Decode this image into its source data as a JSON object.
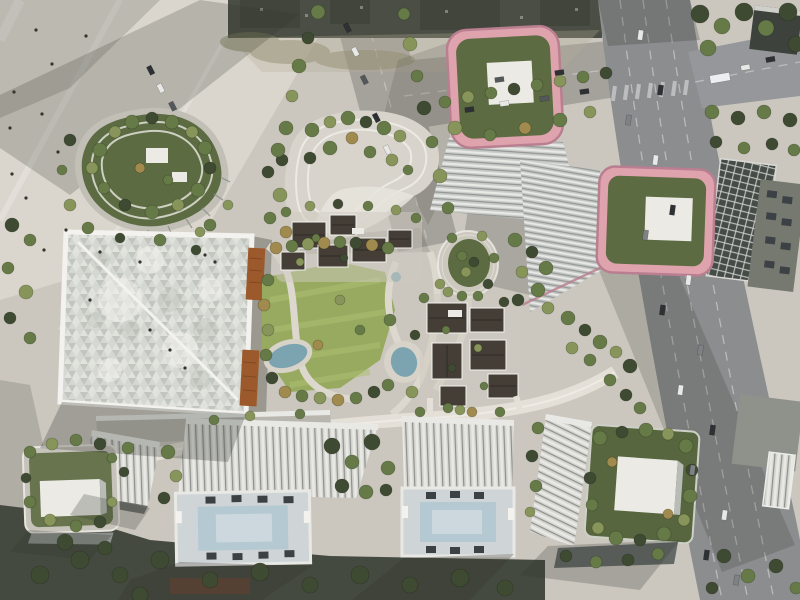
{
  "meta": {
    "type": "aerial-architectural-rendering",
    "description": "Bird's-eye rendering of a mixed-use development: two towers with pink rooftop frames and roof gardens, a square gridshell-roof hall, terraced podium buildings, central park with pools and courtyard village, white office slabs with rooftop courtyards, plazas and an adjacent multi-lane highway"
  },
  "objects": [
    "plaza",
    "top-left-road",
    "cross-road",
    "highway",
    "side-road",
    "rounded-triangle-podium",
    "curvy-terraced-podium",
    "tower-1-pink-roof-garden",
    "tower-2-pink-roof-garden",
    "gridshell-hall",
    "copper-panels",
    "central-park",
    "lawn",
    "pools",
    "oval-sunken-garden",
    "courtyard-village",
    "elevated-walkway",
    "office-slab-a",
    "office-slab-b",
    "roof-garden-building-southeast",
    "green-roof-building-southwest",
    "striped-midrise",
    "existing-city-buildings",
    "trees",
    "cars",
    "pedestrians",
    "shadows"
  ],
  "palette": {
    "ground": "#cbc7bf",
    "plaza": "#dbd6cd",
    "shadow": "#33362f",
    "city": "#4a4e44",
    "olive": "#7c7d58",
    "road": "#a5a29b",
    "asphalt": "#8b8d8f",
    "lane": "#c6c6c3",
    "treeDark": "#3f4a32",
    "tree": "#667a47",
    "treeLight": "#87955a",
    "treeTan": "#a08a4e",
    "lawn": "#97aa60",
    "lawnStripe": "#aebf72",
    "pool": "#7ba4b0",
    "pink": "#dfa3ae",
    "pinkDark": "#b97f90",
    "garden": "#5c6b42",
    "pad": "#ebeae5",
    "white": "#f3f2ee",
    "facade": "#c3c5c1",
    "facadeDark": "#8d908c",
    "ribLight": "#e8e9e5",
    "gridBase": "#d5d7d2",
    "gridTriA": "#c3c6bf",
    "gridTriB": "#e0e2dc",
    "copper": "#9c5a2c",
    "darkRoof": "#443e36",
    "courtyard": "#b5c9d3",
    "slabFace": "#d7d6d1",
    "cityRoof": "#75796f",
    "glassDark": "#454b47",
    "brown": "#6f4731",
    "deck": "#d8d3c9"
  }
}
